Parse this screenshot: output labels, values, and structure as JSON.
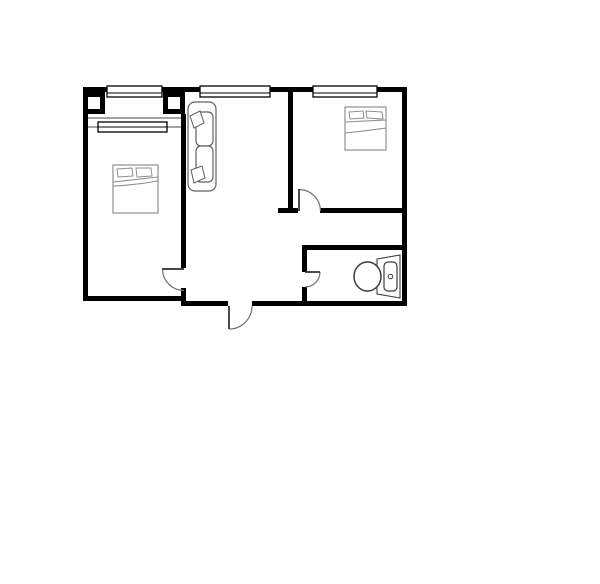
{
  "canvas": {
    "width": 600,
    "height": 584,
    "background": "#ffffff"
  },
  "palette": {
    "wall": "#000000",
    "pier_fill": "#000000",
    "pier_inner": "#ffffff",
    "thin_line": "#4a4a4a",
    "window_stroke": "#000000",
    "window_fill": "#ffffff",
    "door_leaf": "#2b2b2b",
    "door_arc": "#707070",
    "bed_stroke": "#8f8f8f",
    "sofa_stroke": "#606060",
    "toilet_stroke": "#3c3c3c",
    "fixture_fill": "#ffffff"
  },
  "rooms": [
    {
      "name": "bedroom-left"
    },
    {
      "name": "living-room"
    },
    {
      "name": "bedroom-right"
    },
    {
      "name": "bathroom"
    }
  ],
  "walls": [
    {
      "name": "wall-top-left",
      "x": 83,
      "y": 87,
      "w": 24,
      "h": 5
    },
    {
      "name": "wall-top-mid-1",
      "x": 162,
      "y": 87,
      "w": 39,
      "h": 5
    },
    {
      "name": "wall-top-mid-2",
      "x": 270,
      "y": 87,
      "w": 44,
      "h": 5
    },
    {
      "name": "wall-top-right",
      "x": 376,
      "y": 87,
      "w": 31,
      "h": 5
    },
    {
      "name": "wall-left",
      "x": 83,
      "y": 87,
      "w": 5,
      "h": 214
    },
    {
      "name": "wall-right",
      "x": 402,
      "y": 87,
      "w": 5,
      "h": 219
    },
    {
      "name": "wall-bottom-left",
      "x": 83,
      "y": 296,
      "w": 103,
      "h": 5
    },
    {
      "name": "wall-bottom-mid",
      "x": 186,
      "y": 301,
      "w": 42,
      "h": 5
    },
    {
      "name": "wall-bottom-right",
      "x": 252,
      "y": 301,
      "w": 155,
      "h": 5
    },
    {
      "name": "wall-divider-left-upper",
      "x": 181,
      "y": 114,
      "w": 5,
      "h": 154
    },
    {
      "name": "wall-divider-left-lower",
      "x": 181,
      "y": 288,
      "w": 5,
      "h": 18
    },
    {
      "name": "wall-divider-right",
      "x": 288,
      "y": 92,
      "w": 5,
      "h": 121
    },
    {
      "name": "wall-divider-right-stub",
      "x": 278,
      "y": 208,
      "w": 20,
      "h": 5
    },
    {
      "name": "wall-bedroom-right-bottom",
      "x": 320,
      "y": 208,
      "w": 82,
      "h": 5
    },
    {
      "name": "wall-bath-top",
      "x": 302,
      "y": 245,
      "w": 100,
      "h": 5
    },
    {
      "name": "wall-bath-left-upper",
      "x": 302,
      "y": 250,
      "w": 5,
      "h": 22
    },
    {
      "name": "wall-bath-left-lower",
      "x": 302,
      "y": 287,
      "w": 5,
      "h": 14
    }
  ],
  "piers": [
    {
      "name": "pier-bay-left",
      "x": 83,
      "y": 92,
      "w": 22,
      "h": 22,
      "border": 5
    },
    {
      "name": "pier-bay-right",
      "x": 163,
      "y": 92,
      "w": 22,
      "h": 22,
      "border": 5
    }
  ],
  "thin_lines": [
    {
      "name": "inner-wall-line",
      "x1": 88,
      "y1": 118,
      "x2": 181,
      "y2": 118
    },
    {
      "name": "window-sill-left",
      "x1": 88,
      "y1": 127,
      "x2": 98,
      "y2": 127
    },
    {
      "name": "window-sill-right",
      "x1": 167,
      "y1": 127,
      "x2": 181,
      "y2": 127
    }
  ],
  "windows": [
    {
      "name": "window-bedroom-left-outer",
      "x": 107,
      "y": 86,
      "w": 55,
      "h": 11,
      "mid": 93
    },
    {
      "name": "window-bedroom-left-inner",
      "x": 98,
      "y": 122,
      "w": 69,
      "h": 10,
      "mid": 127
    },
    {
      "name": "window-living",
      "x": 200,
      "y": 86,
      "w": 70,
      "h": 11,
      "mid": 93
    },
    {
      "name": "window-bedroom-right",
      "x": 313,
      "y": 86,
      "w": 64,
      "h": 11,
      "mid": 93
    }
  ],
  "doors": [
    {
      "name": "door-bedroom-left",
      "leaf": {
        "x1": 162,
        "y1": 269,
        "x2": 184,
        "y2": 269
      },
      "arc": "M 162.5 269 A 21.5 21.5 0 0 0 184 290.5"
    },
    {
      "name": "door-bedroom-right",
      "leaf": {
        "x1": 299,
        "y1": 189,
        "x2": 299,
        "y2": 211
      },
      "arc": "M 299 189.5 A 21.5 21.5 0 0 1 320.5 211"
    },
    {
      "name": "door-bathroom",
      "leaf": {
        "x1": 305,
        "y1": 272,
        "x2": 320,
        "y2": 272
      },
      "arc": "M 320 272 A 15 15 0 0 1 305 287"
    },
    {
      "name": "door-entrance",
      "leaf": {
        "x1": 229,
        "y1": 306,
        "x2": 229,
        "y2": 329
      },
      "arc": "M 229 329 A 23 23 0 0 0 252 306"
    }
  ],
  "furniture": [
    {
      "name": "bed-left",
      "stroke": "bed_stroke",
      "parts": [
        {
          "t": "rect",
          "x": 113,
          "y": 165,
          "w": 45,
          "h": 48,
          "f": 1
        },
        {
          "t": "poly",
          "points": "117,169 132,168 133,176 118,177",
          "f": 1
        },
        {
          "t": "poly",
          "points": "136,168 151,168 152,176 137,177",
          "f": 1
        },
        {
          "t": "path",
          "d": "M 113 182 L 158 177"
        },
        {
          "t": "path",
          "d": "M 113 186 Q 136 185 158 181"
        }
      ]
    },
    {
      "name": "bed-right",
      "stroke": "bed_stroke",
      "parts": [
        {
          "t": "rect",
          "x": 345,
          "y": 107,
          "w": 41,
          "h": 43,
          "f": 1
        },
        {
          "t": "poly",
          "points": "349,112 363,111 364,118 350,119",
          "f": 1
        },
        {
          "t": "poly",
          "points": "366,111 382,112 383,119 367,118",
          "f": 1
        },
        {
          "t": "path",
          "d": "M 345 122 L 386 120"
        },
        {
          "t": "path",
          "d": "M 345 133 Q 366 131 386 128"
        }
      ]
    },
    {
      "name": "sofa",
      "stroke": "sofa_stroke",
      "parts": [
        {
          "t": "rect",
          "x": 188,
          "y": 102,
          "w": 28,
          "h": 89,
          "rx": 7,
          "f": 1
        },
        {
          "t": "rect",
          "x": 196,
          "y": 112,
          "w": 17,
          "h": 34,
          "rx": 5,
          "f": 1
        },
        {
          "t": "rect",
          "x": 196,
          "y": 146,
          "w": 17,
          "h": 36,
          "rx": 5,
          "f": 1
        },
        {
          "t": "poly",
          "points": "190,116 200,111 204,123 194,128",
          "f": 1
        },
        {
          "t": "poly",
          "points": "191,170 202,166 205,178 194,183",
          "f": 1
        }
      ]
    },
    {
      "name": "toilet",
      "stroke": "toilet_stroke",
      "parts": [
        {
          "t": "path",
          "d": "M 377 259 L 400 255 L 400 298 L 377 294 Z",
          "f": 1
        },
        {
          "t": "rect",
          "x": 384,
          "y": 262,
          "w": 13,
          "h": 29,
          "rx": 4,
          "f": 1
        },
        {
          "t": "circle",
          "cx": 390.5,
          "cy": 276.5,
          "r": 2.3
        },
        {
          "t": "ellipse",
          "cx": 367.5,
          "cy": 276.5,
          "rx": 13.5,
          "ry": 14.5,
          "f": 1
        }
      ]
    }
  ]
}
